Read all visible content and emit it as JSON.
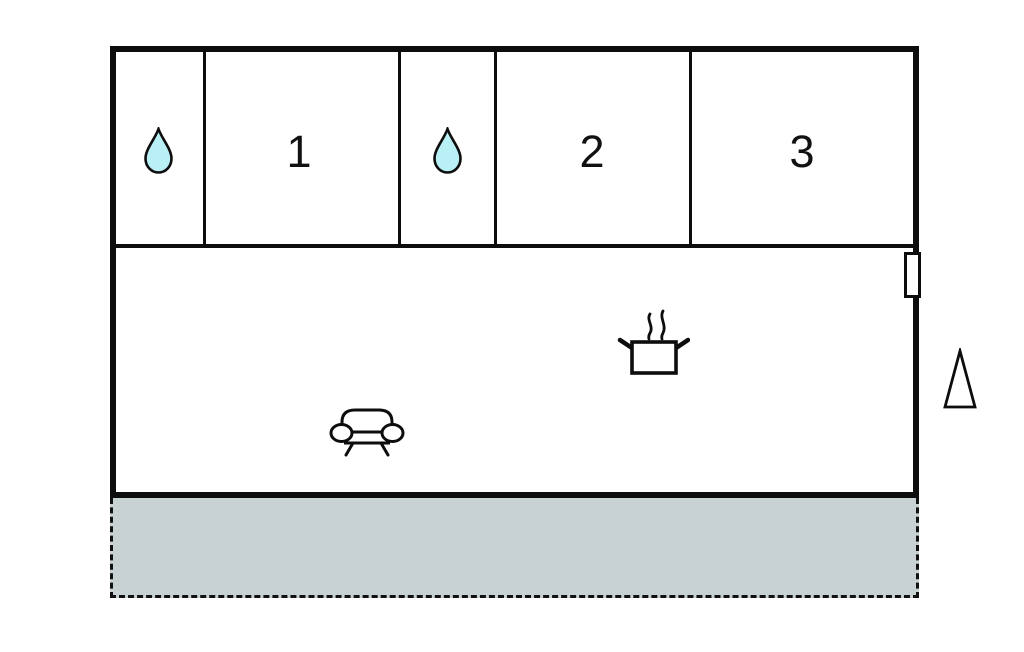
{
  "floorplan": {
    "type": "property-floor-plan",
    "rooms": [
      {
        "name": "bathroom-1",
        "label": "",
        "icon": "water-drop-icon"
      },
      {
        "name": "room-1",
        "label": "1",
        "icon": ""
      },
      {
        "name": "bathroom-2",
        "label": "",
        "icon": "water-drop-icon"
      },
      {
        "name": "room-2",
        "label": "2",
        "icon": ""
      },
      {
        "name": "room-3",
        "label": "3",
        "icon": ""
      }
    ],
    "living_area": {
      "icons": [
        "cooking-pot-icon",
        "sofa-icon"
      ]
    },
    "markers": [
      "door-window-marker",
      "north-triangle-marker"
    ],
    "terrace": {
      "name": "terrace",
      "border_style": "dashed"
    },
    "colors": {
      "wall": "#0d0d0d",
      "water_drop_fill": "#b8f0f5",
      "water_drop_stroke": "#0d0d0d",
      "terrace_fill": "#c9d2d2",
      "background": "#ffffff"
    }
  }
}
